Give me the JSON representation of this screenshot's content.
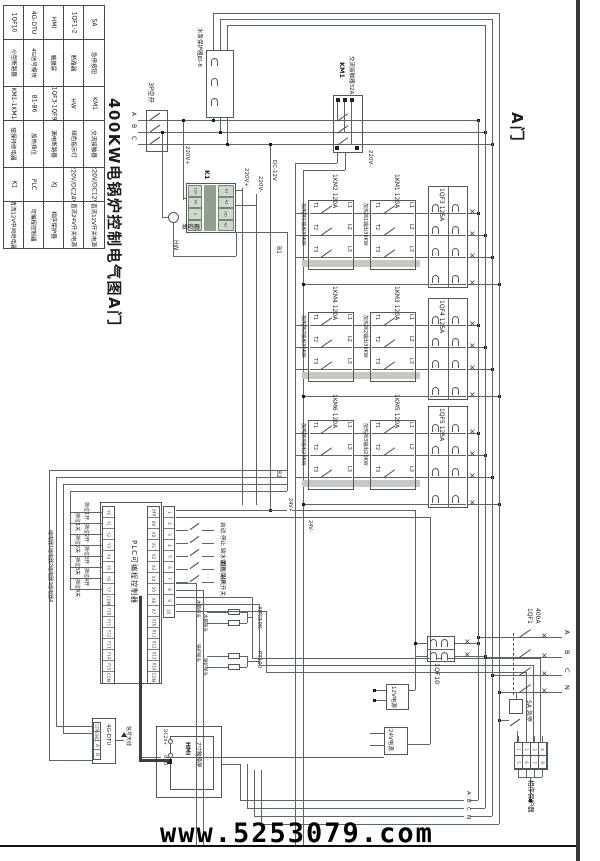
{
  "title": "400KW电锅炉控制电气图A门",
  "door_label": "A门",
  "watermark": "www.5253079.com",
  "legend": {
    "columns": [
      [
        "1QF10",
        "小型断路器",
        "1KM1-1KM14",
        "磁保持继电器",
        "K1",
        "直流12V中间继电器"
      ],
      [
        "4G-DTU",
        "4G信号模块",
        "B1-B6",
        "加热挡位",
        "PLC",
        "可编程控制器"
      ],
      [
        "HMI",
        "触摸屏",
        "1QF3-1QF9",
        "漏电断路器",
        "XJ",
        "相序保护器"
      ],
      [
        "1QF1-2",
        "断路器",
        "HW",
        "绿色指示灯",
        "220V/DC24V",
        "直流24V开关电源"
      ],
      [
        "SA",
        "急停按钮",
        "KM1",
        "交流接触器",
        "220V/DC12V",
        "直流12V开关电源"
      ]
    ]
  },
  "top": {
    "b3p": "3P空开",
    "jd8": "水泵保护器JD-8",
    "km1": "KM1",
    "km1_desc": "交流接触器32A",
    "phases": [
      "A",
      "B",
      "C"
    ]
  },
  "k1": {
    "name": "K1",
    "buzzer": "蜂鸣器",
    "hw": "HW",
    "pins_l": [
      "12V",
      "0V",
      "S",
      "N"
    ],
    "pins_r": [
      "A1",
      "A2",
      "NO",
      "NC"
    ]
  },
  "wl": {
    "v220p_a": "220V+",
    "v220m_km": "220V-",
    "v220p_k": "220V+",
    "v220m_k": "220V-",
    "dc12": "DC-12V",
    "b1": "B1",
    "b2": "B2",
    "f24p": "24V+",
    "f24m": "24V-"
  },
  "hg": {
    "t": [
      "T1",
      "T2",
      "T3"
    ],
    "l": [
      "L1",
      "L2",
      "L3"
    ]
  },
  "groups": [
    {
      "left_name": "1KM2 120A",
      "right_name": "1KM1 120A",
      "left_label": "加热挡1输出30KW",
      "right_label": "加热挡1输出30KW",
      "breaker": "1QF3 125A"
    },
    {
      "left_name": "1KM4 120A",
      "right_name": "1KM3 120A",
      "left_label": "加热挡2输出30KW",
      "right_label": "加热挡2输出30KW",
      "breaker": "1QF4 125A"
    },
    {
      "left_name": "1KM6 120A",
      "right_name": "1KM5 120A",
      "left_label": "加热挡3输出20KW",
      "right_label": "加热挡3输出20KW",
      "breaker": "1QF5 125A"
    }
  ],
  "plc": {
    "label": "PLC可编程控制器",
    "left_pins": [
      "Y0",
      "Y1",
      "Y2",
      "Y3",
      "Y4",
      "Y5",
      "Y6",
      "Y7",
      "COM",
      "Y10",
      "Y11",
      "Y12",
      "Y13",
      "Y14",
      "Y15",
      "COM"
    ],
    "right_pins": [
      "24V",
      "0V",
      "X0",
      "X1",
      "X2",
      "X3",
      "X4",
      "X5",
      "X6",
      "X7",
      "X10",
      "X11",
      "X12",
      "X13",
      "X14",
      "COM"
    ],
    "aux_pins": [
      "1",
      "2",
      "3",
      "4",
      "5",
      "6",
      "7",
      "8",
      "9",
      "10"
    ],
    "out_labels": [
      "挡位1开",
      "挡位1关",
      "挡位2开",
      "挡位2关",
      "挡位3开",
      "挡位3关",
      "挡位4开",
      "挡位4关"
    ],
    "relay_labels": [
      "继电器1",
      "继电器2",
      "继电器3",
      "继电器4"
    ],
    "in_labels": [
      "启动",
      "停止",
      "缺水保护",
      "超温保护",
      "水流开关"
    ]
  },
  "sensors": {
    "ntc": "NTC50K",
    "pt": "PT100",
    "rows": [
      "水箱探头",
      "水箱探头",
      "锅炉探头",
      "锅炉探头"
    ]
  },
  "br": {
    "qf10": "1QF10",
    "ps12": "12V电源",
    "ps24": "24V电源",
    "qf1": "1QF1",
    "qf1_a": "400A",
    "estop": "SA 急停",
    "xj": "相序保护器",
    "xj_pins": [
      "1",
      "2",
      "3",
      "4",
      "5",
      "6",
      "7",
      "8"
    ],
    "phases": [
      "A",
      "B",
      "C",
      "N"
    ],
    "tags": [
      "A",
      "B",
      "C",
      "N"
    ]
  },
  "hmi": {
    "name": "HMI",
    "desc": "7寸触摸屏",
    "pin1": "DC24+",
    "pin2": "GND"
  },
  "dtu": {
    "name": "4G-DTU",
    "ant": "信号天线",
    "pins": [
      "12V",
      "GND",
      "A",
      "B"
    ]
  }
}
